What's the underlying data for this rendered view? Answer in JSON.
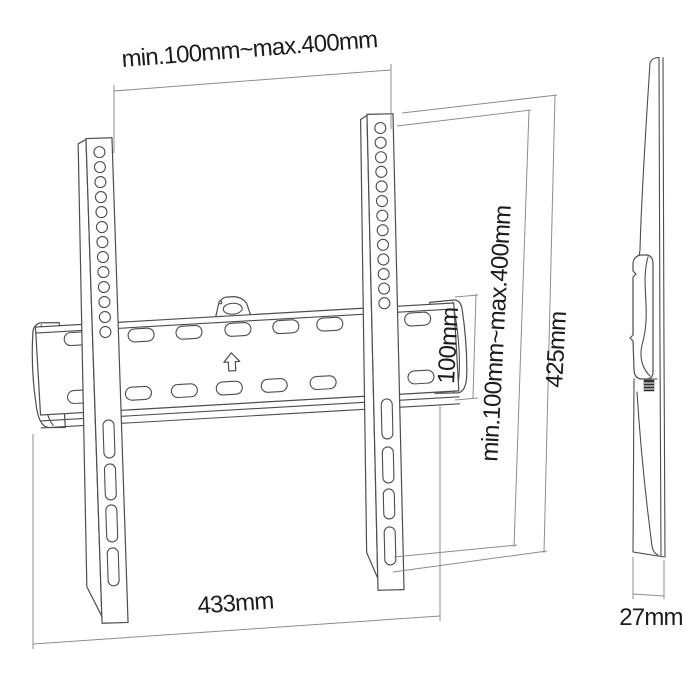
{
  "drawing": {
    "type": "technical-line-drawing",
    "subject": "TV wall mount bracket with dimension annotations",
    "background": "#ffffff",
    "line_color": "#4d4d4d",
    "dim_line_color": "#8c8c8c",
    "text_color": "#1c1c1c",
    "front_view": {
      "labels": {
        "vesa_width": "min.100mm~max.400mm",
        "plate_height": "100mm",
        "vesa_height": "min.100mm~max.400mm",
        "total_height": "425mm",
        "total_width": "433mm"
      },
      "icons": {
        "up_arrow": "up-arrow-icon",
        "hook": "hanging-hook-icon"
      }
    },
    "side_view": {
      "labels": {
        "depth": "27mm"
      }
    }
  }
}
